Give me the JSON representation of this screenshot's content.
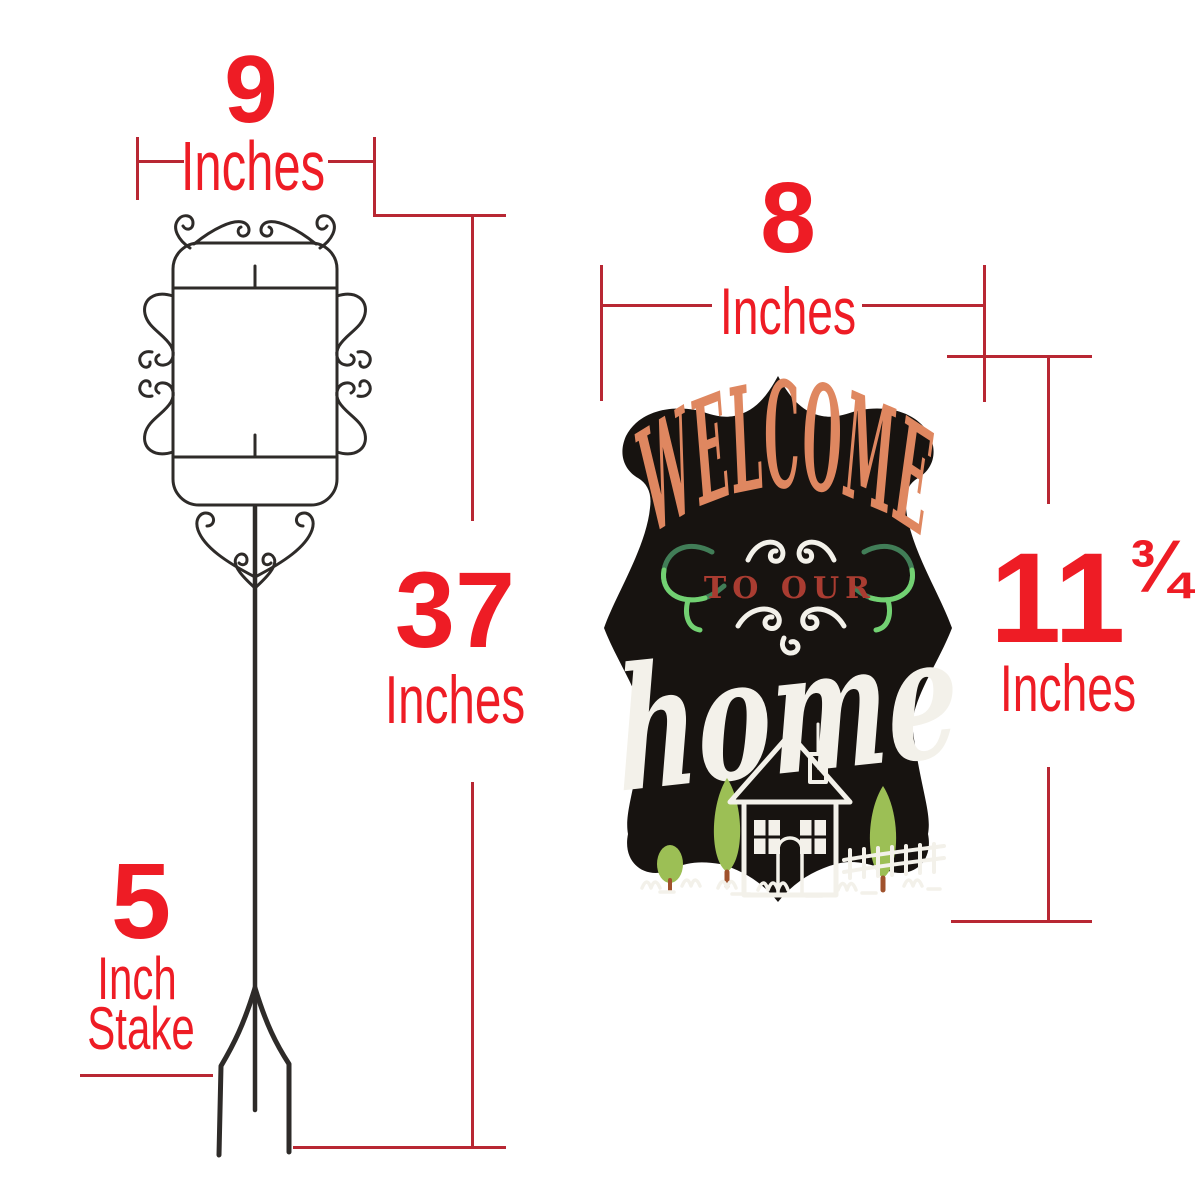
{
  "colors": {
    "canvasBg": "#ffffff",
    "dimensionText": "#ee1c25",
    "dimensionLine": "#b82733",
    "standStroke": "#2e2b29",
    "signBg": "#171310",
    "welcome": "#df8760",
    "toOur": "#a93c31",
    "chalk": "#f3f1ea",
    "flourishGreen": "#72d172",
    "flourishDarkGreen": "#417d57",
    "roofRed": "#b91c1c",
    "doorBrown": "#7b4427",
    "treeGreen": "#9cbf55",
    "trunkBrown": "#a0522d"
  },
  "stand_diagram": {
    "width": {
      "value": "9",
      "unit": "Inches"
    },
    "height": {
      "value": "37",
      "unit": "Inches"
    },
    "stake": {
      "value": "5",
      "unit_word": "Inch",
      "object_word": "Stake"
    }
  },
  "sign_diagram": {
    "width": {
      "value": "8",
      "unit": "Inches"
    },
    "height": {
      "value": "11",
      "fraction": "¾",
      "unit": "Inches"
    },
    "sign_text": {
      "line1": "WELCOME",
      "line2": "TO OUR",
      "line3": "home"
    }
  }
}
